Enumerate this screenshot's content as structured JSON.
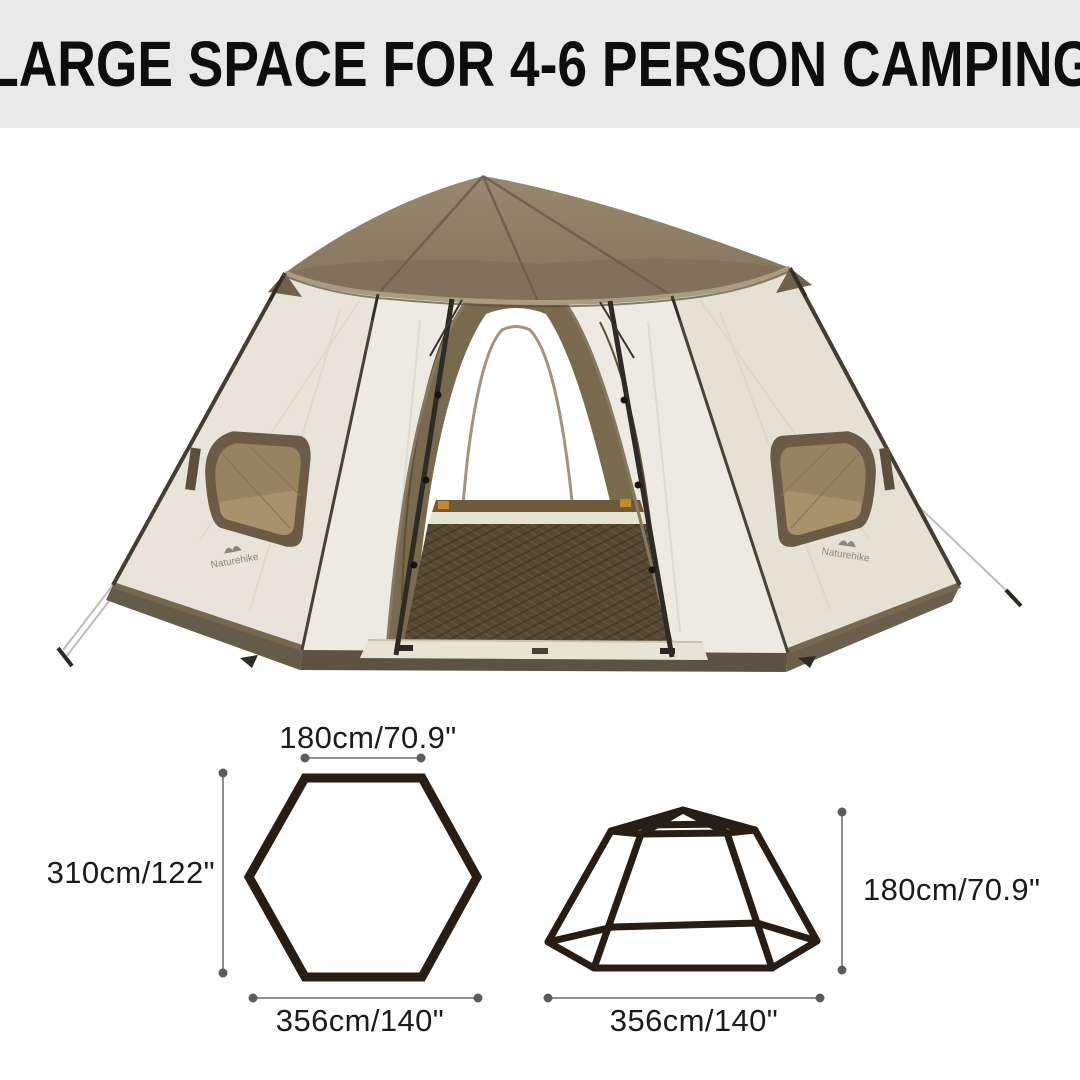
{
  "banner": {
    "title": "LARGE SPACE FOR 4-6 PERSON CAMPING",
    "bg_color": "#e9e9e9",
    "text_color": "#0d0d0d"
  },
  "tent_photo": {
    "brand": "Naturehike",
    "roof_color": "#8d7c66",
    "wall_color": "#edeae1",
    "skirt_color": "#5e5343",
    "mat_color": "#564732",
    "window_mesh_color": "#9c8868"
  },
  "diagrams": {
    "line_color": "#281d15",
    "dim_line_color": "#8f8f8f",
    "text_color": "#1b1b1b",
    "floor_hexagon": {
      "top_width": "180cm/70.9\"",
      "height": "310cm/122\"",
      "width": "356cm/140\""
    },
    "side_profile": {
      "height": "180cm/70.9\"",
      "width": "356cm/140\""
    }
  }
}
